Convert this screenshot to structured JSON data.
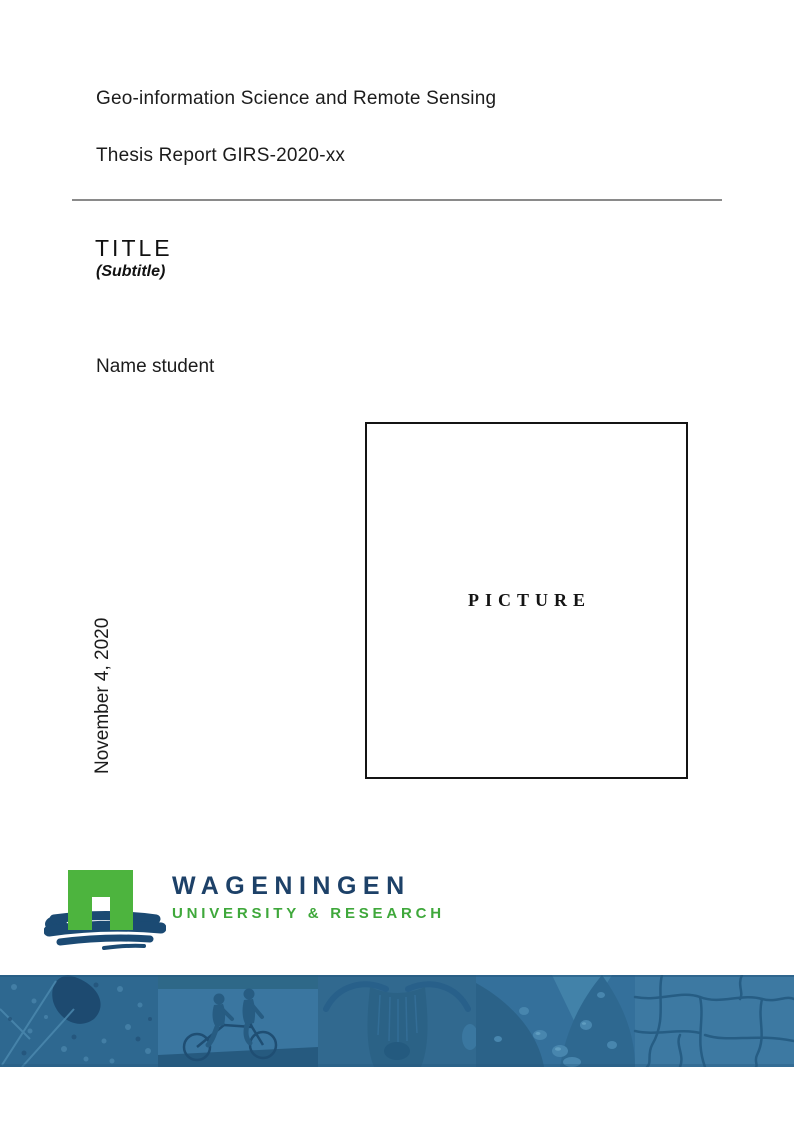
{
  "document": {
    "department": "Geo-information Science and Remote Sensing",
    "report_number": "Thesis Report GIRS-2020-xx",
    "title": "TITLE",
    "subtitle": "(Subtitle)",
    "author": "Name student",
    "date": "November 4, 2020",
    "picture_placeholder": "PICTURE"
  },
  "branding": {
    "university_name": "WAGENINGEN",
    "university_tagline": "UNIVERSITY & RESEARCH",
    "colors": {
      "logo_green": "#4db43e",
      "logo_navy_text": "#1d4168",
      "logo_brush_blue": "#1b4a73",
      "tagline_green": "#3fa83b",
      "strip_base_blue": "#31698f",
      "rule_gray": "#8a8a8a"
    }
  },
  "footer_strip": {
    "style": "blue duotone photo montage",
    "segments": [
      {
        "name": "aerial-map"
      },
      {
        "name": "tandem-cyclists"
      },
      {
        "name": "highland-cow"
      },
      {
        "name": "leaf-water-droplets"
      },
      {
        "name": "cracked-earth"
      }
    ]
  }
}
